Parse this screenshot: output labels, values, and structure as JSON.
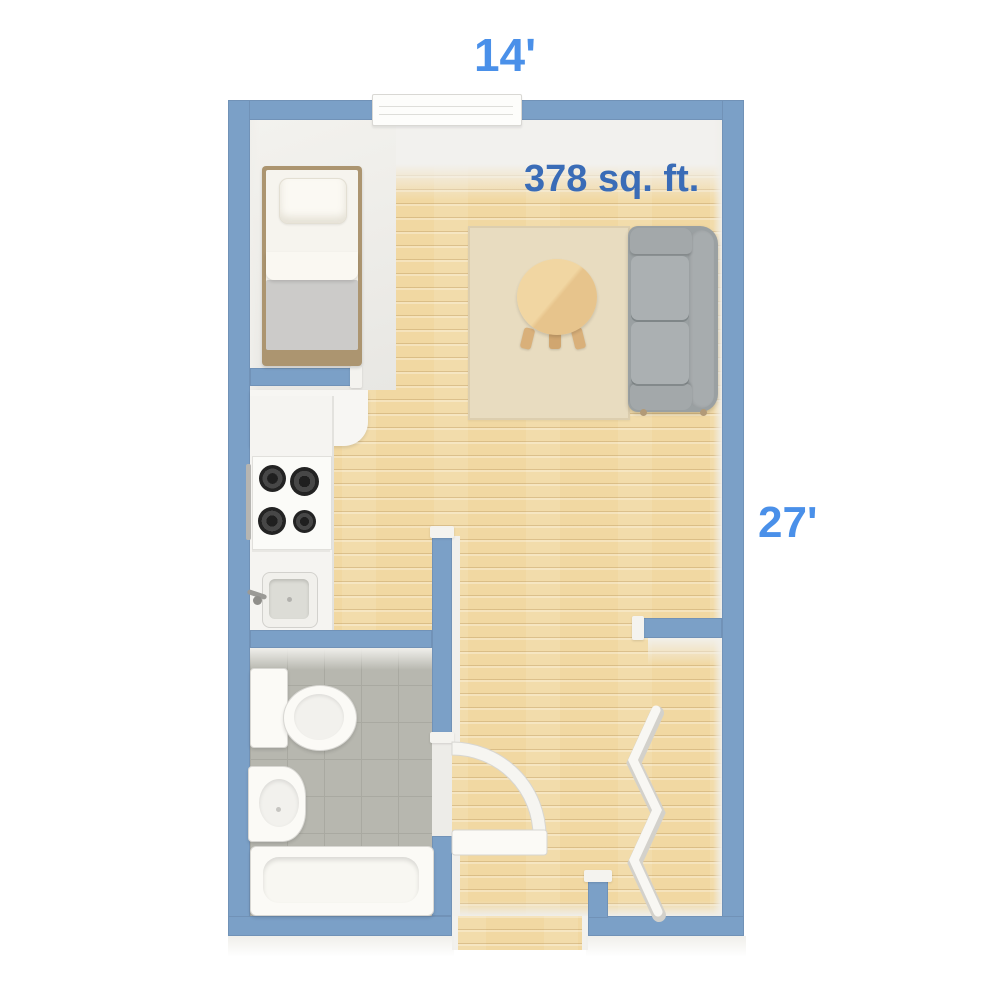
{
  "labels": {
    "width": "14'",
    "height": "27'",
    "area": "378 sq. ft."
  },
  "colors": {
    "wall": "#7ba0c7",
    "label_blue": "#4a90e9",
    "area_blue": "#3a6cb7",
    "wood": "#f1d8a2",
    "tile": "#b7b7af",
    "rug": "#e8dcc0",
    "sofa": "#9aa0a2",
    "table_wood": "#e7c48c",
    "bed_blanket": "#cccbc9",
    "bed_frame": "#ac9570"
  },
  "rooms": {
    "main_room": [
      "bed",
      "kitchen-counter",
      "stove",
      "kitchen-sink",
      "rug",
      "round-table",
      "sofa"
    ],
    "bathroom": [
      "toilet",
      "pedestal-sink",
      "bathtub"
    ],
    "closet": [
      "accordion-door"
    ],
    "openings": [
      "window",
      "bathroom-door",
      "entry-opening"
    ]
  }
}
